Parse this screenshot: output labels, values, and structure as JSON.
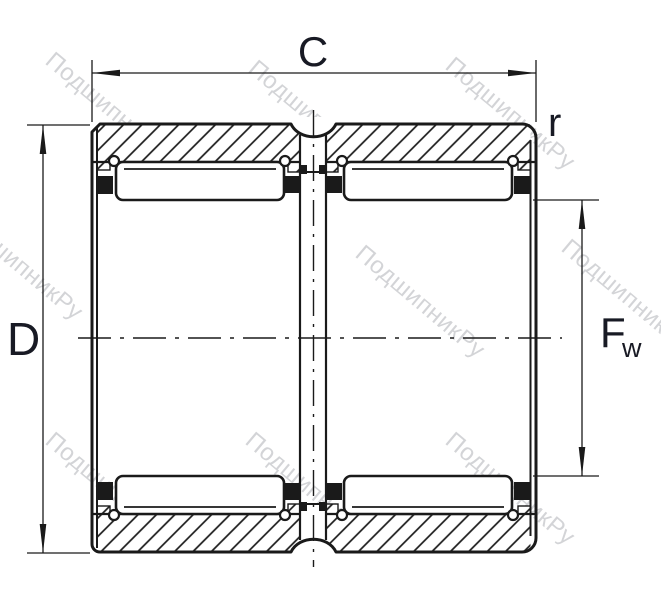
{
  "drawing": {
    "type": "bearing-cross-section",
    "subject": "double-row needle roller bearing, sectional view",
    "line_color": "#1a1a1a",
    "label_color": "#181a24",
    "watermark_color": "#cfd0d3",
    "background_color": "#ffffff",
    "hatch_angle_deg": 45
  },
  "labels": {
    "width_dim": "C",
    "outer_diameter_dim": "D",
    "raceway_dim_main": "F",
    "raceway_dim_sub": "w",
    "corner_radius": "r"
  },
  "watermark": {
    "text": "ПодшипникРу"
  }
}
